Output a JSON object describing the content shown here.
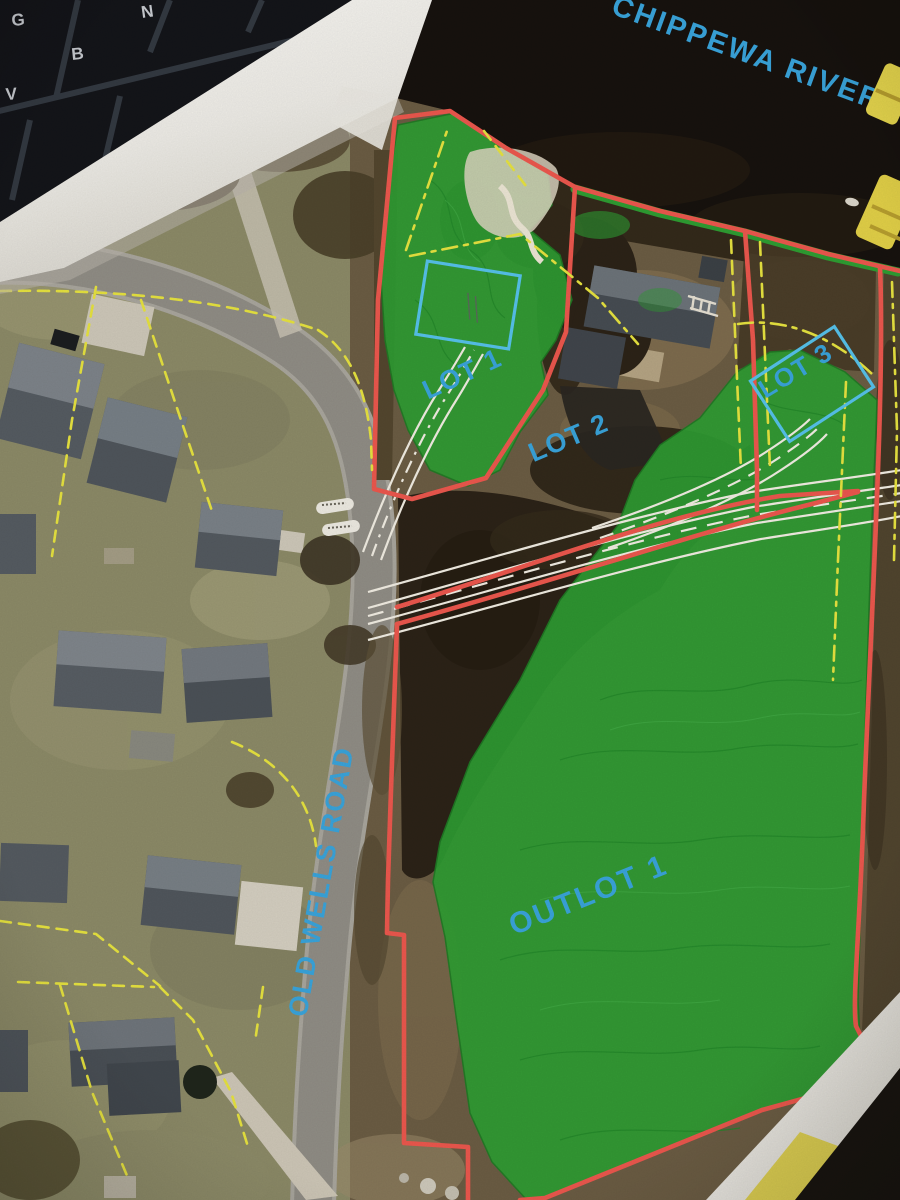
{
  "photo": {
    "keyboard_keys": [
      "G",
      "N",
      "V",
      "B"
    ],
    "map": {
      "water_label": "CHIPPEWA RIVER",
      "road_label": "OLD WELLS ROAD",
      "lot_labels": [
        "LOT 1",
        "LOT 2",
        "LOT 3",
        "OUTLOT 1"
      ],
      "edge_label_partial": "H",
      "colors": {
        "lot_boundary": "#ee584e",
        "existing_parcel_lines": "#e8e440",
        "greenspace_overlay": "#2f9e33",
        "label_text": "#3aa5dc",
        "building_envelope": "#57c3ec"
      }
    }
  }
}
